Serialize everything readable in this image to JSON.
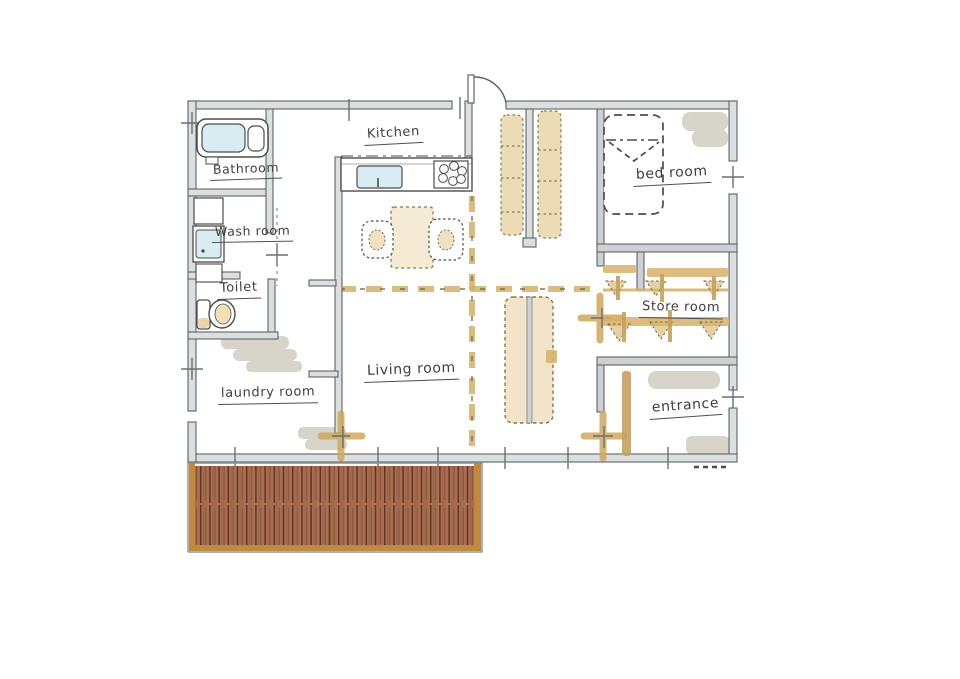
{
  "drawing": {
    "type": "hand-drawn house floor plan sketch",
    "rooms": [
      {
        "id": "kitchen",
        "label": "Kitchen"
      },
      {
        "id": "bathroom",
        "label": "Bathroom"
      },
      {
        "id": "washroom",
        "label": "Wash room"
      },
      {
        "id": "toilet",
        "label": "Toilet"
      },
      {
        "id": "laundry",
        "label": "laundry room"
      },
      {
        "id": "living",
        "label": "Living room"
      },
      {
        "id": "bedroom",
        "label": "bed room"
      },
      {
        "id": "store",
        "label": "Store room"
      },
      {
        "id": "entrance",
        "label": "entrance"
      }
    ],
    "fixtures": [
      "bathtub",
      "washbasin-unit",
      "toilet",
      "kitchen-counter",
      "kitchen-sink",
      "stove",
      "dining-table",
      "chairs",
      "bed",
      "corridor-shelves",
      "sliding-door-unit",
      "hanger-rails",
      "shoe-cabinet",
      "wood-deck",
      "entry-door"
    ],
    "colors": {
      "paper": "#ffffff",
      "wall_line": "#5f6367",
      "wall_fill": "#dcdfe0",
      "ink": "#3f3f3f",
      "tan_marker": "#cfa85c",
      "tan_fill": "#e0c484",
      "water_blue": "#d8ecf2",
      "wash_gray": "#c8c4b6",
      "deck_plank": "#ad6f4f",
      "deck_frame": "#c08a3e"
    }
  }
}
